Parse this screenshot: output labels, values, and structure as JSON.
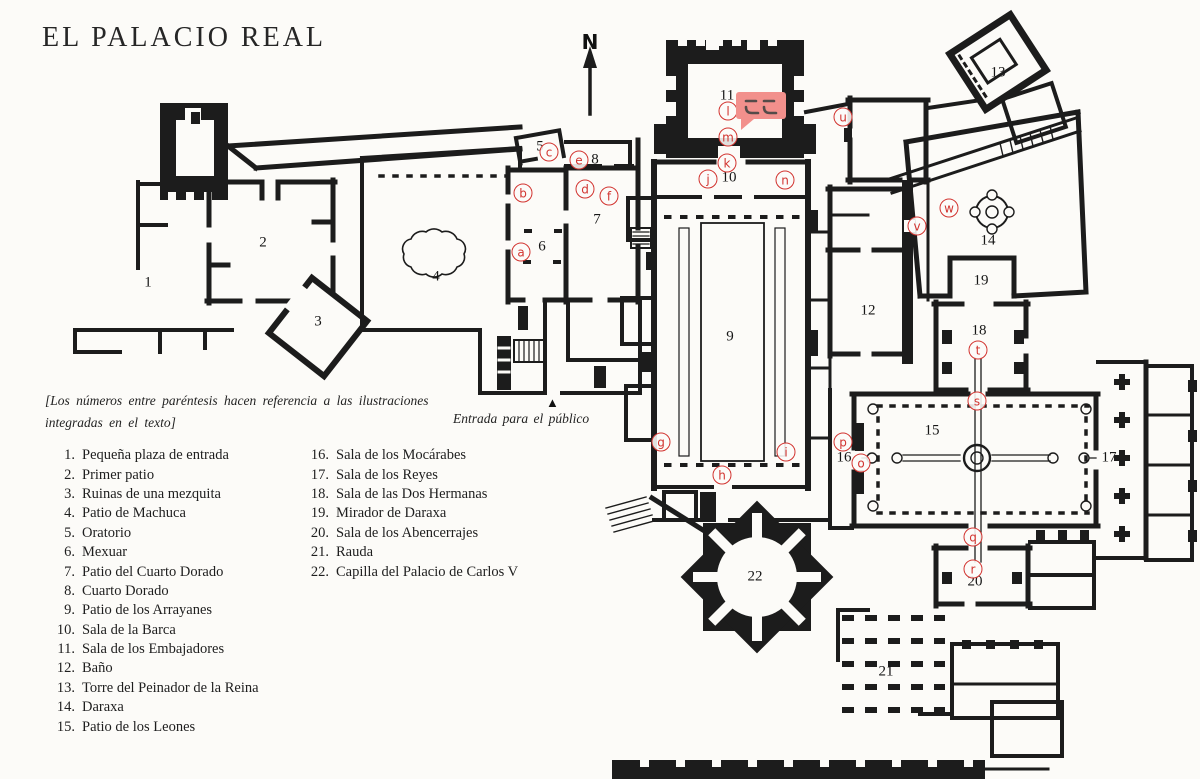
{
  "page": {
    "title": "EL PALACIO REAL",
    "background": "#fcfbf8",
    "ink": "#1c1c1c"
  },
  "compass": {
    "label": "N"
  },
  "note": {
    "text": "[Los números entre paréntesis hacen referencia a las ilustraciones integradas en el texto]"
  },
  "entrance": {
    "label": "Entrada para el público",
    "marker": "▲"
  },
  "annotation": {
    "text": "ここ",
    "color": "#f2908c"
  },
  "legend": {
    "column1": [
      {
        "num": "1.",
        "label": "Pequeña plaza de entrada"
      },
      {
        "num": "2.",
        "label": "Primer patio"
      },
      {
        "num": "3.",
        "label": "Ruinas de una mezquita"
      },
      {
        "num": "4.",
        "label": "Patio de Machuca"
      },
      {
        "num": "5.",
        "label": "Oratorio"
      },
      {
        "num": "6.",
        "label": "Mexuar"
      },
      {
        "num": "7.",
        "label": "Patio del Cuarto Dorado"
      },
      {
        "num": "8.",
        "label": "Cuarto Dorado"
      },
      {
        "num": "9.",
        "label": "Patio de los Arrayanes"
      },
      {
        "num": "10.",
        "label": "Sala de la Barca"
      },
      {
        "num": "11.",
        "label": "Sala de los Embajadores"
      },
      {
        "num": "12.",
        "label": "Baño"
      },
      {
        "num": "13.",
        "label": "Torre del Peinador de la Reina"
      },
      {
        "num": "14.",
        "label": "Daraxa"
      },
      {
        "num": "15.",
        "label": "Patio de los Leones"
      }
    ],
    "column2": [
      {
        "num": "16.",
        "label": "Sala de los Mocárabes"
      },
      {
        "num": "17.",
        "label": "Sala de los Reyes"
      },
      {
        "num": "18.",
        "label": "Sala de las Dos Hermanas"
      },
      {
        "num": "19.",
        "label": "Mirador de Daraxa"
      },
      {
        "num": "20.",
        "label": "Sala de los Abencerrajes"
      },
      {
        "num": "21.",
        "label": "Rauda"
      },
      {
        "num": "22.",
        "label": "Capilla del Palacio de Carlos V"
      }
    ]
  },
  "plan": {
    "marker_color": "#d23430",
    "room_numbers": [
      {
        "n": "1",
        "x": 148,
        "y": 283
      },
      {
        "n": "2",
        "x": 263,
        "y": 243
      },
      {
        "n": "3",
        "x": 318,
        "y": 322
      },
      {
        "n": "4",
        "x": 436,
        "y": 277
      },
      {
        "n": "5",
        "x": 540,
        "y": 147
      },
      {
        "n": "6",
        "x": 542,
        "y": 247
      },
      {
        "n": "7",
        "x": 597,
        "y": 220
      },
      {
        "n": "8",
        "x": 595,
        "y": 160
      },
      {
        "n": "9",
        "x": 730,
        "y": 337
      },
      {
        "n": "10",
        "x": 729,
        "y": 178
      },
      {
        "n": "11",
        "x": 727,
        "y": 96
      },
      {
        "n": "12",
        "x": 868,
        "y": 311
      },
      {
        "n": "13",
        "x": 998,
        "y": 73
      },
      {
        "n": "14",
        "x": 988,
        "y": 241
      },
      {
        "n": "15",
        "x": 932,
        "y": 431
      },
      {
        "n": "16",
        "x": 844,
        "y": 458
      },
      {
        "n": "17",
        "x": 1109,
        "y": 458
      },
      {
        "n": "18",
        "x": 979,
        "y": 331
      },
      {
        "n": "19",
        "x": 981,
        "y": 281
      },
      {
        "n": "20",
        "x": 975,
        "y": 582
      },
      {
        "n": "21",
        "x": 886,
        "y": 672
      },
      {
        "n": "22",
        "x": 755,
        "y": 577
      }
    ],
    "letter_markers": [
      {
        "letter": "a",
        "x": 521,
        "y": 252
      },
      {
        "letter": "b",
        "x": 523,
        "y": 193
      },
      {
        "letter": "c",
        "x": 549,
        "y": 152
      },
      {
        "letter": "d",
        "x": 585,
        "y": 189
      },
      {
        "letter": "e",
        "x": 579,
        "y": 160
      },
      {
        "letter": "f",
        "x": 609,
        "y": 196
      },
      {
        "letter": "g",
        "x": 661,
        "y": 442
      },
      {
        "letter": "h",
        "x": 722,
        "y": 475
      },
      {
        "letter": "i",
        "x": 786,
        "y": 452
      },
      {
        "letter": "j",
        "x": 708,
        "y": 179
      },
      {
        "letter": "k",
        "x": 727,
        "y": 163
      },
      {
        "letter": "l",
        "x": 728,
        "y": 111
      },
      {
        "letter": "m",
        "x": 728,
        "y": 137
      },
      {
        "letter": "n",
        "x": 785,
        "y": 180
      },
      {
        "letter": "o",
        "x": 861,
        "y": 463
      },
      {
        "letter": "p",
        "x": 843,
        "y": 442
      },
      {
        "letter": "q",
        "x": 973,
        "y": 537
      },
      {
        "letter": "r",
        "x": 973,
        "y": 569
      },
      {
        "letter": "s",
        "x": 977,
        "y": 401
      },
      {
        "letter": "t",
        "x": 978,
        "y": 350
      },
      {
        "letter": "u",
        "x": 843,
        "y": 117
      },
      {
        "letter": "v",
        "x": 917,
        "y": 226
      },
      {
        "letter": "w",
        "x": 949,
        "y": 208
      }
    ]
  }
}
